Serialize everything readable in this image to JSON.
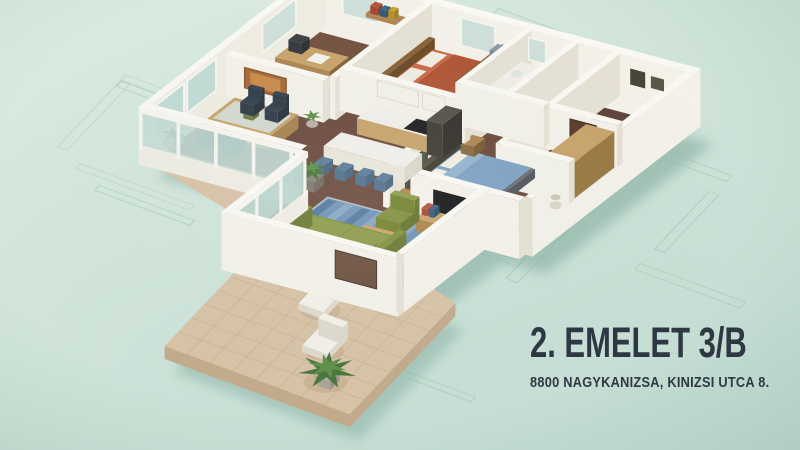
{
  "caption": {
    "title": "2. EMELET 3/B",
    "subtitle": "8800 NAGYKANIZSA, KINIZSI UTCA 8."
  },
  "colors": {
    "bg_top": "#dcece2",
    "bg_bottom": "#c4dcd2",
    "blueprint": "#9fc2b4",
    "shadow": "#8fb4a6",
    "text": "#2d3844",
    "wall_top": "#faf8f3",
    "wall_sun": "#f4f1e9",
    "wall_shade": "#e6e1d4",
    "fascia": "#efece3",
    "floor": "#6b4a3d",
    "floor_dark": "#5f4337",
    "floor_warm": "#74513f",
    "bath_floor": "#7a6452",
    "floor_stripe": "#7d584a",
    "terrace": "#d8c2a6",
    "terrace_line": "#c9b194",
    "terrace_side": "#c3aa8c",
    "glass": "#c2dcd5",
    "window": "#cfe0da",
    "frame_white": "#f6f4ee",
    "wood": "#b08452",
    "wood_dark": "#8a6138",
    "wood_light": "#c9a36b",
    "sofa": "#81903f",
    "sofa_light": "#8d9c4b",
    "sofa_dark": "#6c7a33",
    "rug": "#6f93b4",
    "rug_light": "#9db7cc",
    "rug_dark": "#3f6488",
    "bed1": "#c96b4a",
    "bed1_dark": "#b05535",
    "bed2": "#7fa2c2",
    "bed2_light": "#95b3cf",
    "pillow": "#f1ede3",
    "tv": "#17181a",
    "door": "#5a3b28",
    "fridge": "#413c36",
    "appliance": "#1e1e20",
    "chair_navy": "#35424f",
    "stool": "#5b7c99",
    "plant": "#5f8f4a",
    "plant_dark": "#49763a",
    "pot": "#eeebe2",
    "white_furn": "#f3f0e7",
    "white_furn_side": "#ded9cc",
    "art_dark": "#3a3f35",
    "counter": "#f1eee8"
  }
}
